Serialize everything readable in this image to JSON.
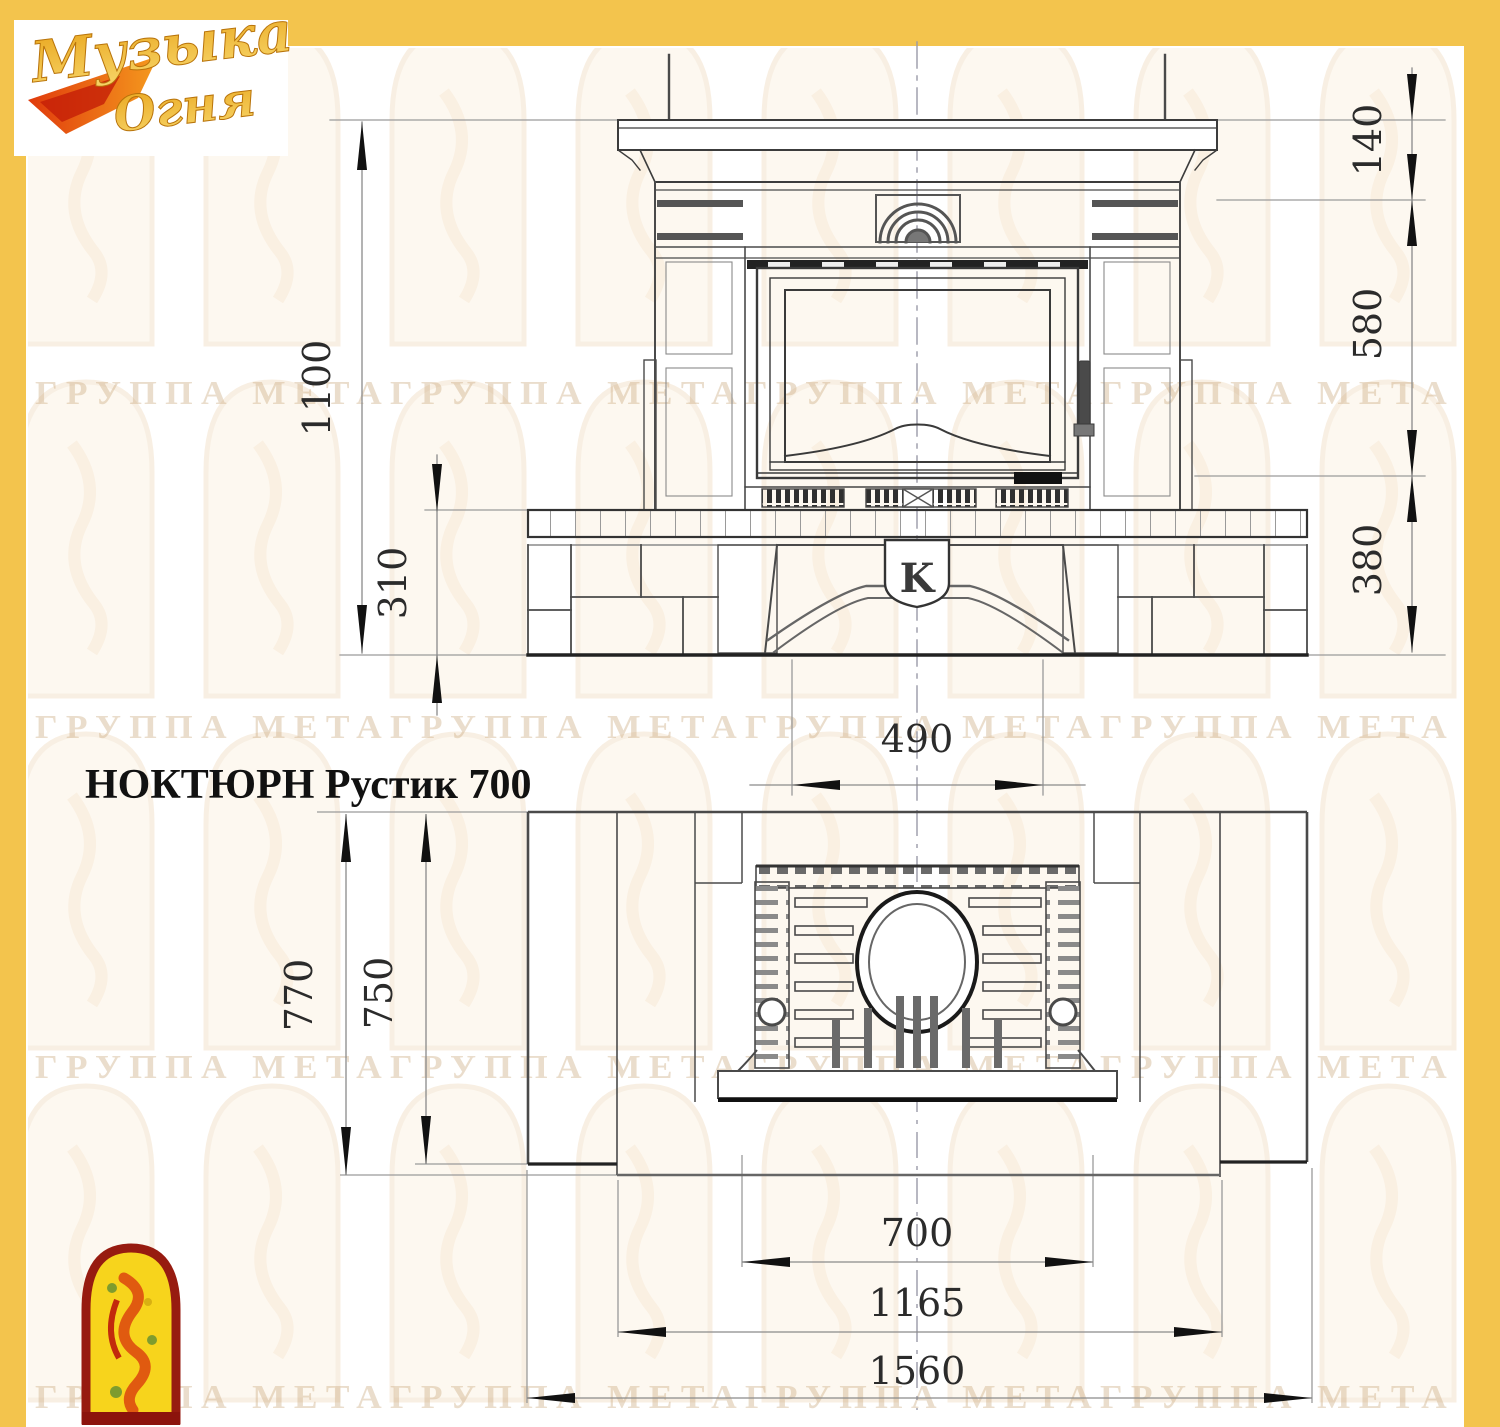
{
  "page": {
    "background": "#ffffff",
    "border_color": "#F3C44D"
  },
  "brand": {
    "logo_line1": "Музыка",
    "logo_line2": "Огня"
  },
  "title": "НОКТЮРН Рустик 700",
  "front_view": {
    "dim_total_height": "1100",
    "dim_hearth_height": "310",
    "dim_shelf_height": "140",
    "dim_portal_height": "580",
    "dim_base_height": "380",
    "dim_flue_width": "490",
    "medallion_letter": "K"
  },
  "plan_view": {
    "dim_total_depth": "770",
    "dim_body_depth": "750",
    "dim_firebox_width": "700",
    "dim_inner_width": "1165",
    "dim_total_width": "1560"
  },
  "watermark": {
    "text": "ГРУППА МЕТАГРУППА МЕТАГРУППА МЕТАГРУППА МЕТА"
  }
}
